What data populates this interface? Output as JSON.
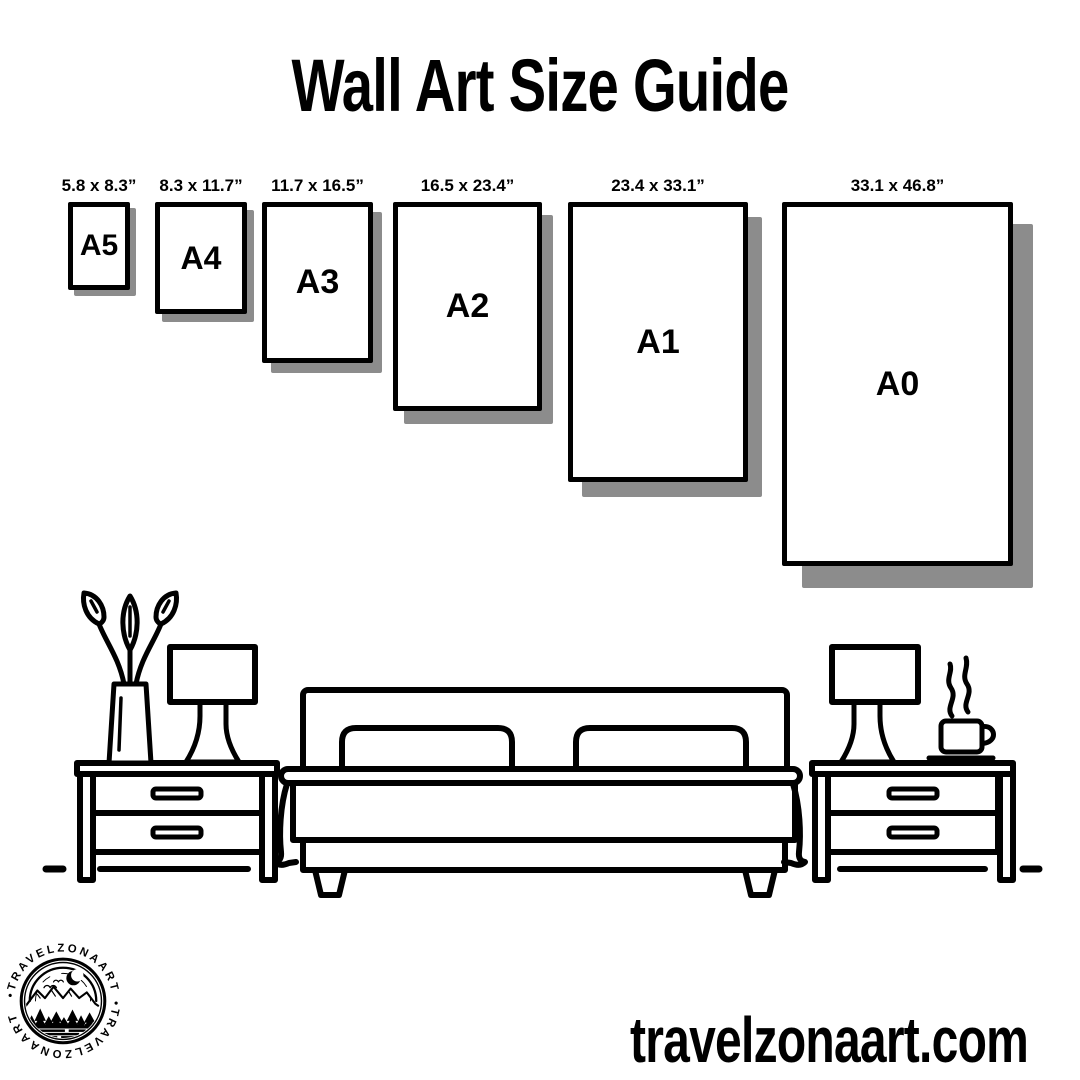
{
  "header": {
    "title": "Wall Art Size Guide"
  },
  "sizes": [
    {
      "code": "A5",
      "dims": "5.8 x 8.3”"
    },
    {
      "code": "A4",
      "dims": "8.3 x 11.7”"
    },
    {
      "code": "A3",
      "dims": "11.7 x 16.5”"
    },
    {
      "code": "A2",
      "dims": "16.5 x 23.4”"
    },
    {
      "code": "A1",
      "dims": "23.4 x 33.1”"
    },
    {
      "code": "A0",
      "dims": "33.1 x 46.8”"
    }
  ],
  "footer": {
    "website": "travelzonaart.com"
  },
  "logo": {
    "arc_text": "•TRAVELZONAART"
  },
  "colors": {
    "ink": "#000000",
    "shadow": "#8c8c8c",
    "paper": "#ffffff",
    "background": "#ffffff"
  }
}
